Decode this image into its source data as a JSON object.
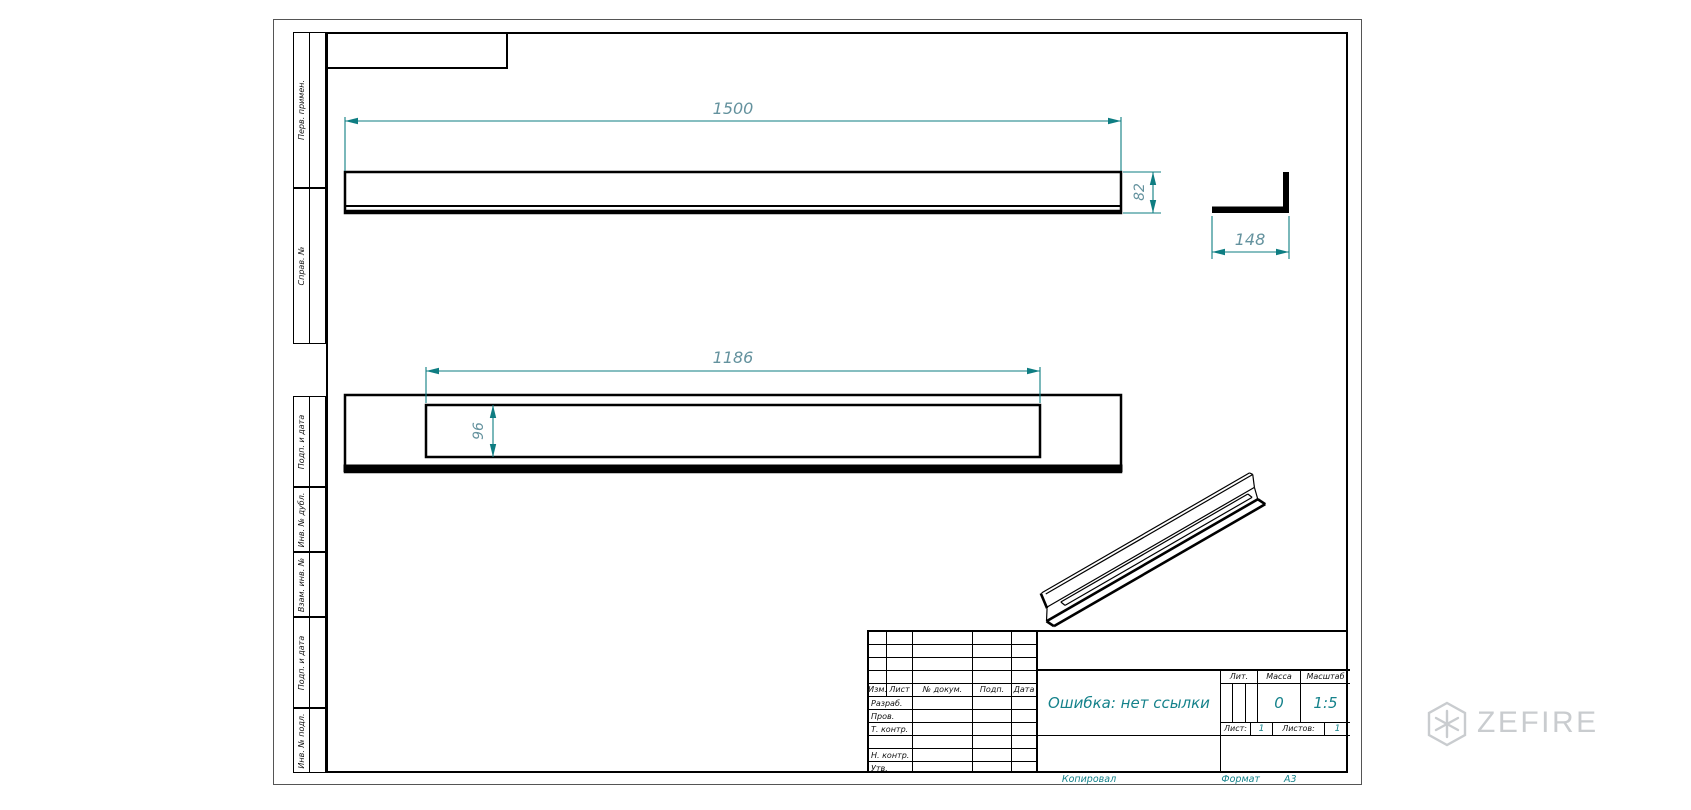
{
  "margin_labels": {
    "perv": "Перв. примен.",
    "sprav": "Справ. №",
    "podp1": "Подп. и дата",
    "dubl": "Инв. № дубл.",
    "vzam": "Взам. инв. №",
    "podp2": "Подп. и дата",
    "podl": "Инв. № подл."
  },
  "dimensions": {
    "length": "1500",
    "height": "82",
    "width": "148",
    "slot_length": "1186",
    "slot_width": "96"
  },
  "title_block": {
    "header_cols": [
      "Изм.",
      "Лист",
      "№ докум.",
      "Подп.",
      "Дата"
    ],
    "sign_rows": [
      "Разраб.",
      "Пров.",
      "Т. контр.",
      "",
      "Н. контр.",
      "Утв."
    ],
    "doc_title": "Ошибка: нет ссылки",
    "lit_label": "Лит.",
    "mass_label": "Масса",
    "scale_label": "Масштаб",
    "mass_value": "0",
    "scale_value": "1:5",
    "sheet_label": "Лист:",
    "sheet_value": "1",
    "sheets_label": "Листов:",
    "sheets_value": "1",
    "copied": "Копировал",
    "format_label": "Формат",
    "format_value": "А3"
  },
  "watermark": {
    "brand": "ZEFIRE"
  },
  "colors": {
    "dim-line": "#0e7d82",
    "dim-text": "#64929e",
    "accent": "#15828b",
    "watermark": "#c9cccf"
  }
}
